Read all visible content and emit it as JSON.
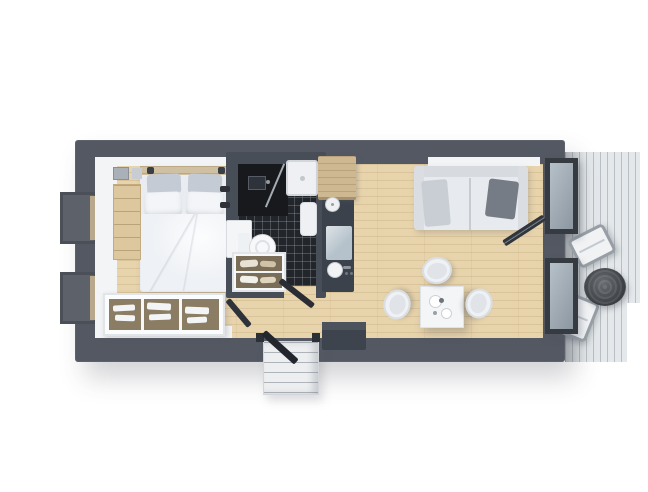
{
  "scene": {
    "description": "Top-down 3D rendered floor plan of a compact rectangular cabin: bedroom on the left, central bathroom with black mosaic tile, kitchenette strip, living-dining area on the right, side deck with lounge chairs, and entry steps with an open front door at the bottom",
    "view": "top-down",
    "style": "3d-architectural-render",
    "background_color": "#ffffff"
  },
  "palette": {
    "wall": "#535862",
    "partition": "#484e58",
    "wood_floor": "#e8d4ac",
    "floor_edge_white": "#f3f4f6",
    "tile_floor": "#22252a",
    "vanity_black": "#17191d",
    "shower_white": "#eef0f3",
    "counter_dark": "#3b424c",
    "cabinet_wood": "#cdb891",
    "hob_glass": "#b6c2cb",
    "sofa_light": "#e7eaee",
    "bed_linen": "#e9ecf0",
    "pillow_gray": "#c5cbd4",
    "dresser_wood": "#dcc79f",
    "deck_boards": "#e4e8ea",
    "ottoman_dark": "#45494e",
    "door_dark": "#23272d",
    "steps_light": "#eceef0",
    "table_white": "#f4f5f7",
    "bench_dark": "#3e444d",
    "headboard_wood": "#cfc0a2"
  },
  "rooms": {
    "bedroom": {
      "items": [
        "double-bed",
        "headboard",
        "gray-pillows",
        "white-pillows",
        "duvet",
        "bedside-dresser",
        "wall-art",
        "wall-lamps",
        "open-wardrobe-shelf",
        "left-window-upper",
        "left-window-lower"
      ]
    },
    "bathroom": {
      "items": [
        "black-mosaic-floor",
        "vanity-counter",
        "vanity-sink",
        "glass-screen",
        "shower-tray",
        "washbasin",
        "toilet",
        "wall-radiator",
        "towel-shelf",
        "shower-fittings",
        "open-door"
      ]
    },
    "kitchen": {
      "items": [
        "overhead-wood-cabinet",
        "dark-counter",
        "round-sink",
        "induction-hob",
        "prep-sink",
        "faucet"
      ]
    },
    "living_dining": {
      "items": [
        "sofa",
        "dark-throw-pillow",
        "blanket",
        "window-sill",
        "dining-table",
        "tableware",
        "dining-chairs",
        "entry-cabinet"
      ],
      "dining_chairs_count": 3
    },
    "deck": {
      "items": [
        "deck-boards",
        "lounge-chair-1",
        "lounge-chair-2",
        "round-ottoman-table",
        "glass-door-top",
        "glass-door-bottom",
        "open-glass-door-blade"
      ],
      "lounge_chairs_count": 2
    },
    "entrance": {
      "items": [
        "entry-steps",
        "open-front-door",
        "door-jambs"
      ]
    }
  }
}
